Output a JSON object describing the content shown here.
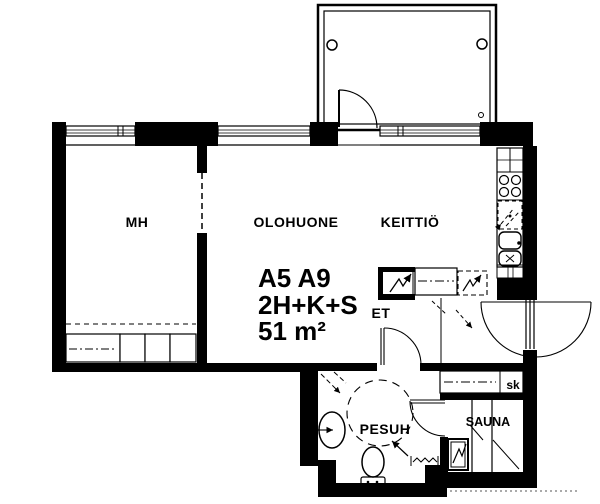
{
  "plan": {
    "colors": {
      "background": "#ffffff",
      "line": "#000000"
    },
    "labels": {
      "bedroom": "MH",
      "living_room": "OLOHUONE",
      "kitchen": "KEITTIÖ",
      "entry": "ET",
      "washroom": "PESUH",
      "sauna": "SAUNA",
      "closet": "sk"
    },
    "apartment": {
      "unit": "A5 A9",
      "type": "2H+K+S",
      "area": "51 m²"
    }
  }
}
